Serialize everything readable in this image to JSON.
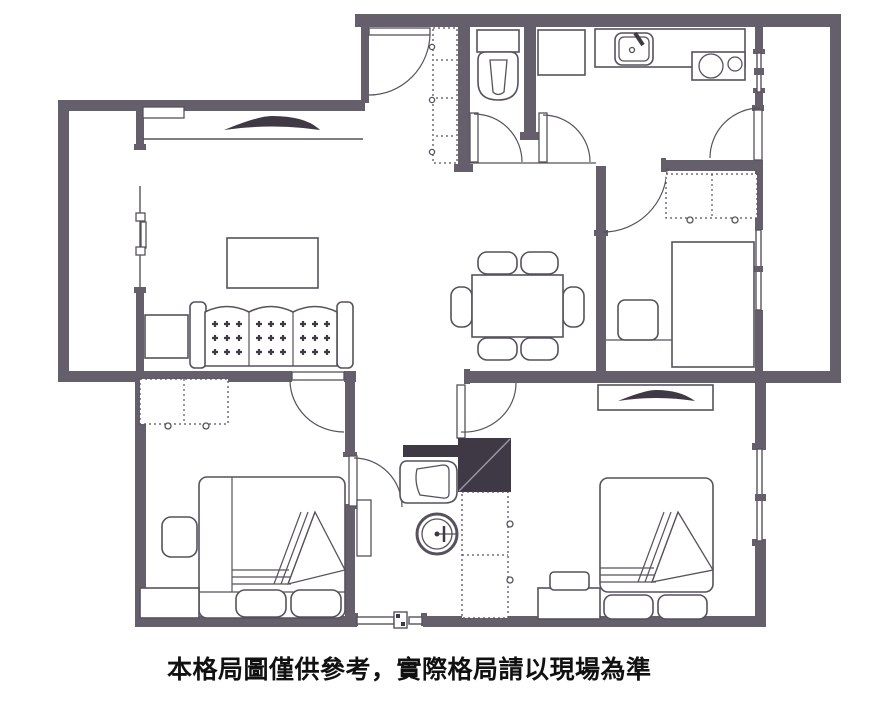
{
  "caption": {
    "text": "本格局圖僅供參考，實際格局請以現場為準"
  },
  "colors": {
    "background": "#ffffff",
    "wall": "#655f6b",
    "line": "#57515d",
    "dark": "#3e3944",
    "text": "#111111"
  }
}
